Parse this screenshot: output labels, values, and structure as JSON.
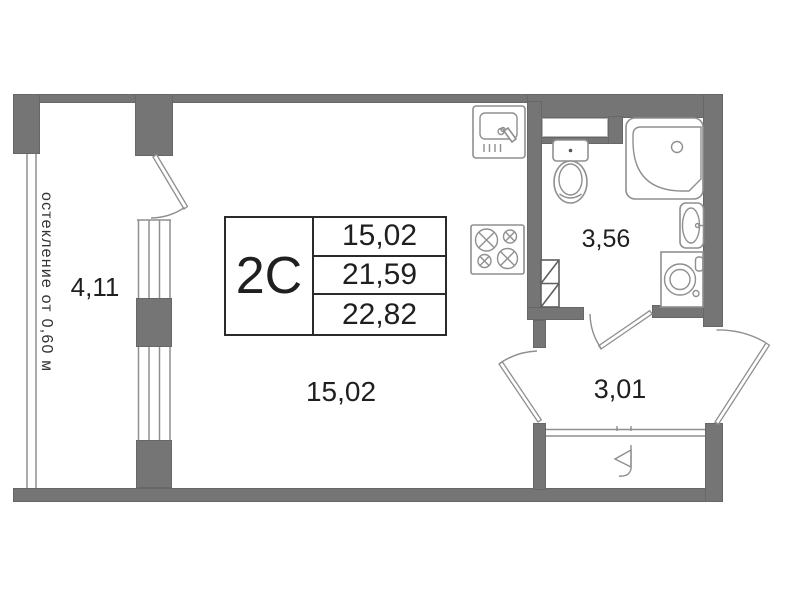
{
  "colors": {
    "wall": "#757575",
    "line": "#8f8f8f",
    "duct": "#5f5f5f",
    "text": "#1f1f1f",
    "border": "#2b2b2b",
    "bg": "#ffffff"
  },
  "stamp": {
    "unit_type": "2С",
    "row1": "15,02",
    "row2": "21,59",
    "row3": "22,82"
  },
  "rooms": {
    "balcony": {
      "area": "4,11",
      "note": "остекление от 0,60 м"
    },
    "living_room": {
      "area": "15,02"
    },
    "bathroom": {
      "area": "3,56"
    },
    "hallway": {
      "area": "3,01"
    }
  },
  "fixtures": [
    "kitchen-sink",
    "stove",
    "toilet",
    "corner-bathtub",
    "washbasin",
    "washing-machine",
    "vent-duct",
    "entry-door-symbol"
  ]
}
